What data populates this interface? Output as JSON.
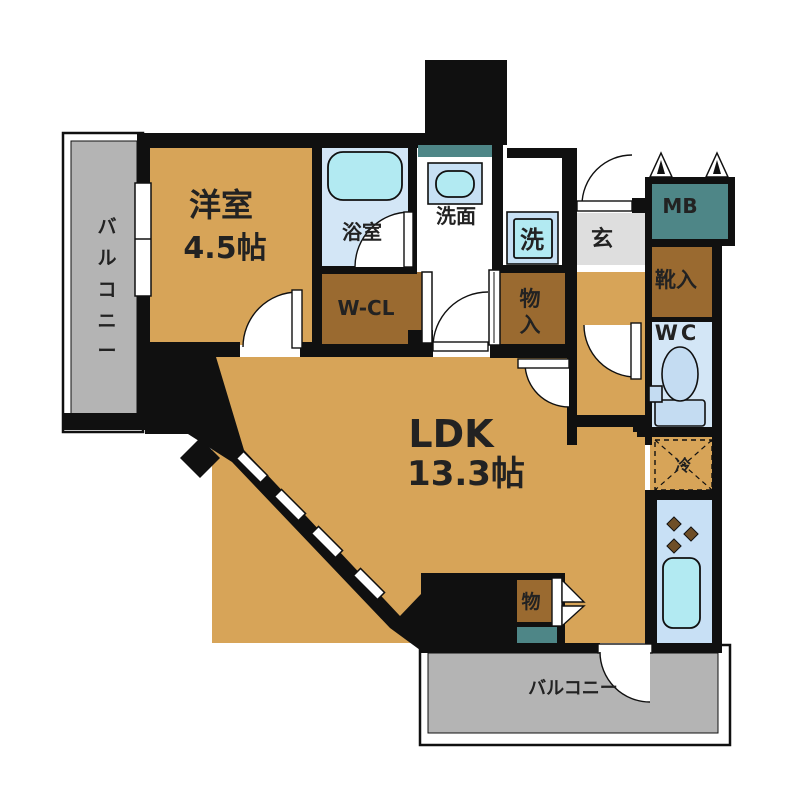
{
  "title": "floor-plan",
  "rooms": {
    "western_room": {
      "name": "洋室",
      "size": "4.5帖",
      "color": "#D7A458"
    },
    "ldk": {
      "name": "LDK",
      "size": "13.3帖",
      "color": "#D7A458"
    },
    "bathroom": {
      "name": "浴室",
      "color": "#D3E6F6"
    },
    "washroom": {
      "name": "洗面",
      "color": "#FFFFFF"
    },
    "washer": {
      "name": "洗",
      "color": "#B2EAF2"
    },
    "entrance": {
      "name": "玄",
      "color": "#DEDEDE"
    },
    "meter_box": {
      "name": "MB",
      "color": "#4E8687"
    },
    "shoe_cabinet": {
      "name": "靴入",
      "color": "#9A6A30"
    },
    "toilet": {
      "name": "WC",
      "color": "#D3E6F6"
    },
    "walk_in_closet": {
      "name": "W-CL",
      "color": "#9A6A30"
    },
    "storage_hall": {
      "chars": [
        "物",
        "入"
      ],
      "color": "#9A6A30"
    },
    "storage_ldk": {
      "name": "物",
      "color": "#9A6A30"
    },
    "refrigerator": {
      "name": "冷"
    },
    "kitchen": {
      "color": "#C8E0F5"
    },
    "balcony_left": {
      "chars": [
        "バ",
        "ル",
        "コ",
        "ニ",
        "ー"
      ],
      "color": "#B4B4B4"
    },
    "balcony_bottom": {
      "name": "バルコニー",
      "color": "#B4B4B4"
    }
  },
  "colors": {
    "wall": "#101010",
    "room_tan": "#D7A458",
    "closet_brown": "#9A6A30",
    "teal": "#4E8687",
    "light_blue": "#D3E6F6",
    "fixture_cyan": "#B2EAF2",
    "toilet_blue": "#C4DCF2",
    "balcony_gray": "#B4B4B4",
    "genkan_gray": "#DEDEDE",
    "burner_brown": "#6E4E27"
  },
  "icons": {
    "bathtub": "bathtub-icon",
    "washbasin": "washbasin-icon",
    "washing_machine": "washing-machine-icon",
    "toilet": "toilet-icon",
    "kitchen_sink": "kitchen-sink-icon",
    "stove_burners": "stove-burners-icon",
    "vents": "vent-icon",
    "bifold_door": "bifold-door-icon",
    "refrigerator_space": "refrigerator-space-dashed-box"
  }
}
